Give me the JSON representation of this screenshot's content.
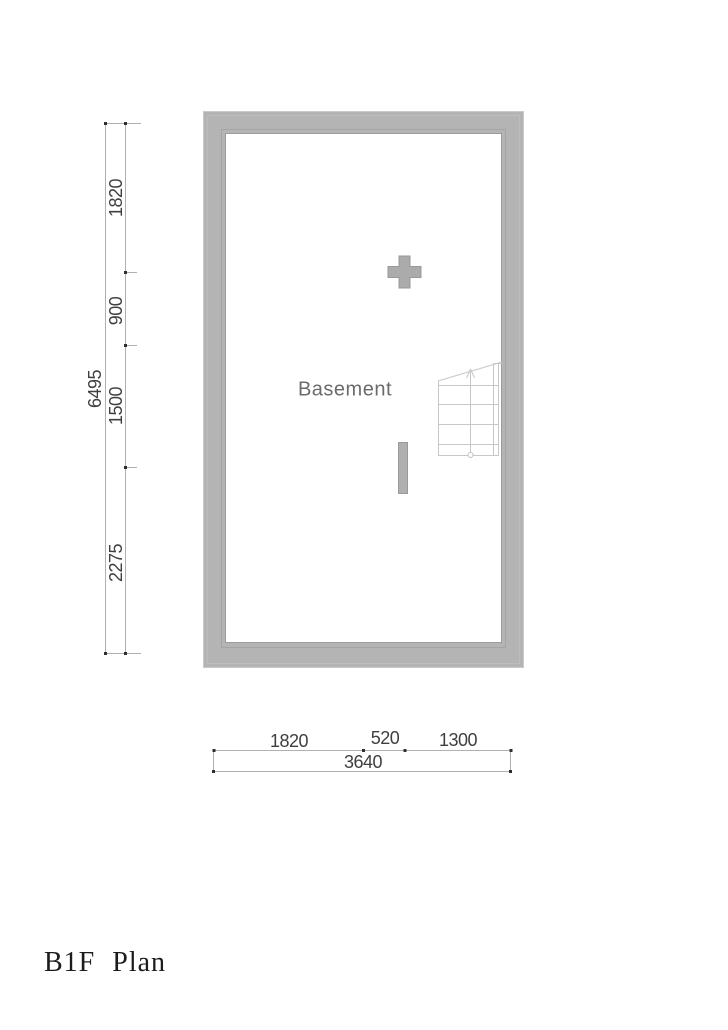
{
  "title": "B1F Plan",
  "room_label": "Basement",
  "dimensions": {
    "left": {
      "total": "6495",
      "segments": [
        "1820",
        "900",
        "1500",
        "2275"
      ]
    },
    "bottom": {
      "total": "3640",
      "segments": [
        "1820",
        "520",
        "1300"
      ]
    }
  },
  "colors": {
    "wall_fill": "#b4b4b4",
    "wall_edge": "#9c9c9c",
    "stair_line": "#c7c7c7",
    "dim_line": "#b0b0b0",
    "dim_tick": "#2f2f2f",
    "dim_text": "#3f3f3f",
    "room_text": "#6b6b6b",
    "title_text": "#1c1c1c"
  }
}
